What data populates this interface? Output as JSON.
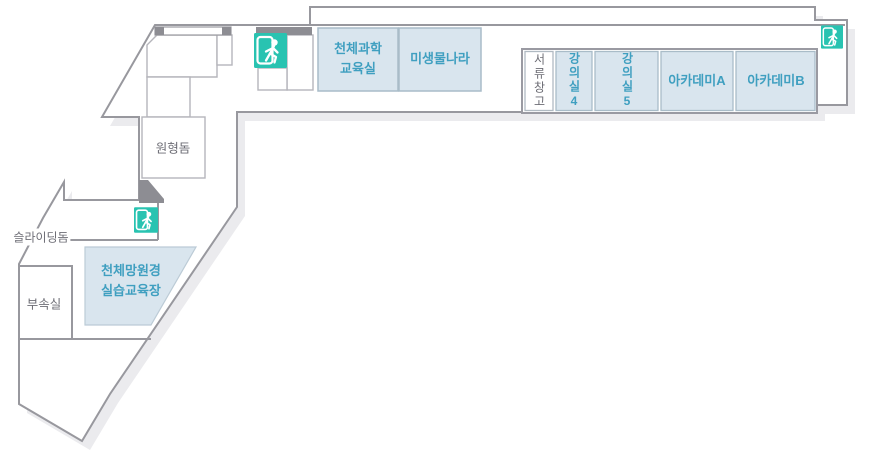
{
  "floor_plan": {
    "rooms": {
      "astro_science_classroom": {
        "label": "천체과학 교육실",
        "lines": [
          "천체과학",
          "교육실"
        ]
      },
      "microbe_world": {
        "label": "미생물나라"
      },
      "document_storage": {
        "label": "서류창고"
      },
      "lecture_room_4": {
        "label": "강의실4"
      },
      "lecture_room_5": {
        "label": "강의실5"
      },
      "academy_a": {
        "label": "아카데미A"
      },
      "academy_b": {
        "label": "아카데미B"
      },
      "circular_dome": {
        "label": "원형돔"
      },
      "sliding_dome": {
        "label": "슬라이딩돔"
      },
      "annex_room": {
        "label": "부속실"
      },
      "telescope_training_center": {
        "label": "천체망원경 실습교육장",
        "lines": [
          "천체망원경",
          "실습교육장"
        ]
      }
    },
    "icons": {
      "emergency_exit": {
        "name": "emergency-exit-icon",
        "count": 3
      }
    },
    "colors": {
      "room_fill": "#d9e5ee",
      "room_border": "#a9bcc8",
      "label_blue": "#3f9fc0",
      "label_gray": "#6d6d75",
      "wall_gray": "#98989e",
      "dark_wall": "#8d8d93",
      "exit_teal": "#29c3b1",
      "shadow": "#ebebee"
    }
  }
}
